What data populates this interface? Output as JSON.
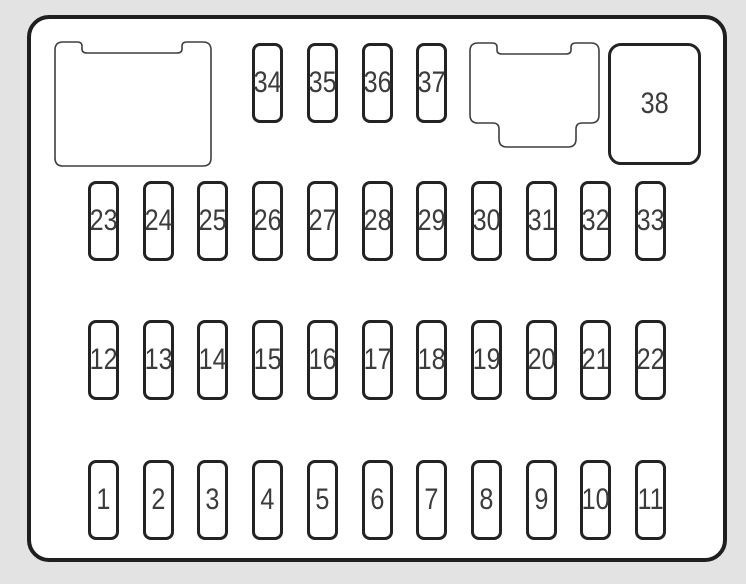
{
  "title": "interior-fuse-box-diagram",
  "colors": {
    "page_background": "#e3e3e3",
    "panel_background": "#ffffff",
    "panel_border": "#1f1f1f",
    "fuse_border": "#232323",
    "shape_outline": "#3f3f3f",
    "number_text": "#3c3c3c"
  },
  "large_fuse": {
    "label": "38"
  },
  "fuse_rows": [
    {
      "name": "top-row-small-fuses",
      "fuses": [
        "34",
        "35",
        "36",
        "37"
      ]
    },
    {
      "name": "second-row-fuses",
      "fuses": [
        "23",
        "24",
        "25",
        "26",
        "27",
        "28",
        "29",
        "30",
        "31",
        "32",
        "33"
      ]
    },
    {
      "name": "third-row-fuses",
      "fuses": [
        "12",
        "13",
        "14",
        "15",
        "16",
        "17",
        "18",
        "19",
        "20",
        "21",
        "22"
      ]
    },
    {
      "name": "bottom-row-fuses",
      "fuses": [
        "1",
        "2",
        "3",
        "4",
        "5",
        "6",
        "7",
        "8",
        "9",
        "10",
        "11"
      ]
    }
  ],
  "shapes": [
    {
      "name": "connector-outline"
    },
    {
      "name": "relay-outline"
    }
  ]
}
